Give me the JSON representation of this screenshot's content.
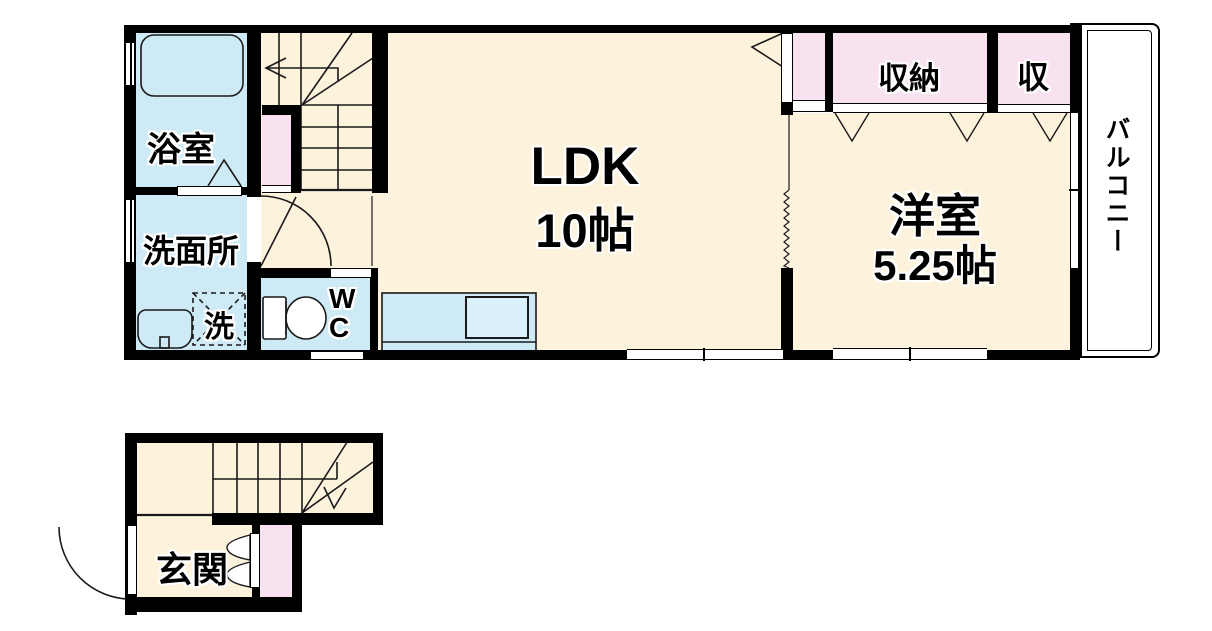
{
  "plan": {
    "upper_floor": {
      "bathroom": "浴室",
      "washroom": "洗面所",
      "washer": "洗",
      "toilet": "WC",
      "ldk": "LDK",
      "ldk_size": "10帖",
      "closet_large": "収納",
      "closet_small": "収",
      "bedroom": "洋室",
      "bedroom_size": "5.25帖",
      "balcony": "バルコニー"
    },
    "lower_floor": {
      "entrance": "玄関"
    },
    "colors": {
      "floor": "#fdf3dd",
      "wet_area": "#cdeaf6",
      "closet": "#f8e2f0",
      "wall": "#000000",
      "balcony": "#ffffff"
    }
  }
}
